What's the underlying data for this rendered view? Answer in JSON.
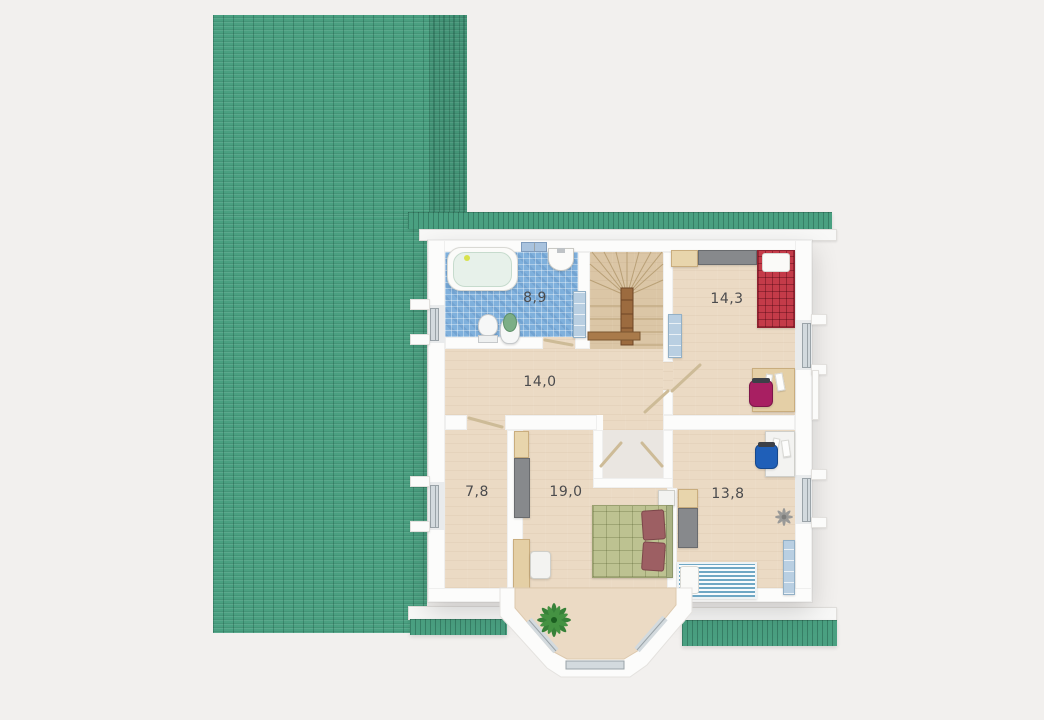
{
  "plan": {
    "type": "residential-floor-plan-3d-top-view",
    "rooms": [
      {
        "name": "bathroom",
        "area_label": "8,9"
      },
      {
        "name": "bedroom-top-right",
        "area_label": "14,3"
      },
      {
        "name": "hallway-landing",
        "area_label": "14,0"
      },
      {
        "name": "room-left",
        "area_label": "7,8"
      },
      {
        "name": "bedroom-main",
        "area_label": "19,0"
      },
      {
        "name": "bedroom-bottom-right",
        "area_label": "13,8"
      }
    ],
    "furniture": {
      "bathroom": [
        "bathtub",
        "wall-window",
        "sink",
        "toilet",
        "bidet",
        "shelf"
      ],
      "bedroom-top-right": [
        "dresser",
        "wardrobe",
        "single-bed-red-plaid",
        "bookshelf",
        "desk",
        "office-chair-magenta"
      ],
      "hallway-landing": [
        "winder-staircase",
        "handrail"
      ],
      "bedroom-main": [
        "double-bed-green",
        "nightstand",
        "cabinet",
        "wardrobe",
        "desk",
        "chair",
        "palm-plant"
      ],
      "bedroom-bottom-right": [
        "desk",
        "office-chair-blue",
        "nightstand",
        "wardrobe",
        "single-bed-blue-striped",
        "shelf",
        "ceiling-fan"
      ]
    }
  },
  "colors": {
    "background": "#f2f0ee",
    "roof": "#4aa081",
    "wall": "#fcfcfb",
    "wood": "#ebdac4",
    "tile_base": "#7fb0dc",
    "niche": "#eae6e1",
    "window_glass": "#d3dade",
    "window_frame": "#9aa3a8",
    "cabinet_beige": "#e8d5ac",
    "wardrobe_gray": "#87898c",
    "shelf_blue": "#b9cfe2",
    "bed_red": "#c43b49",
    "stripe_blue": "#6fa7c4",
    "duvet_green": "#bdc291",
    "pillow_rose": "#9d5f63",
    "chair_magenta": "#a81f62",
    "chair_blue": "#1f5fb8",
    "stair_wood": "#dbc6a6",
    "rail_brown": "#9c6b3f",
    "plant_green": "#2e7d32",
    "label": "#4b4b4d"
  }
}
